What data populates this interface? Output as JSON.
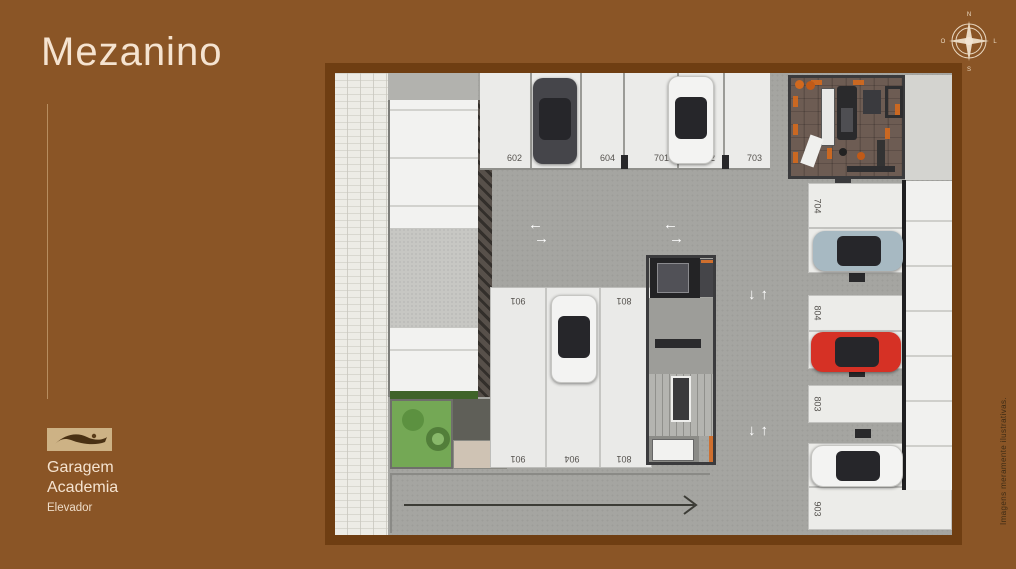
{
  "title": "Mezanino",
  "legend": {
    "line1": "Garagem",
    "line2": "Academia",
    "sub": "Elevador"
  },
  "compass": {
    "n": "N",
    "s": "S",
    "e": "L",
    "w": "O"
  },
  "disclaimer": "Imagens meramente ilustrativas.",
  "icons": {
    "arrow_left": "←",
    "arrow_right": "→",
    "arrow_up": "↑",
    "arrow_down": "↓",
    "ramp_arrow_direction": "right"
  },
  "colors": {
    "background": "#8a5526",
    "plan_frame": "#6f3e12",
    "accent_text": "#f5e3d0",
    "gym_accent_orange": "#d2691e",
    "car_red": "#d63125",
    "car_silver_blue": "#a7b9c2",
    "car_dark_gray": "#45454a",
    "car_white": "#f3f3f2"
  },
  "plan": {
    "top_row": [
      {
        "number": "602",
        "car": "none"
      },
      {
        "number": "603",
        "car": "dark-gray"
      },
      {
        "number": "604",
        "car": "none"
      },
      {
        "number": "701",
        "car": "none"
      },
      {
        "number": "702",
        "car": "white"
      },
      {
        "number": "703",
        "car": "none"
      }
    ],
    "right_column": [
      {
        "number": "704",
        "car": "none"
      },
      {
        "number": "802",
        "car": "silver-blue"
      },
      {
        "number": "804",
        "car": "none"
      },
      {
        "number": "804",
        "car": "red"
      },
      {
        "number": "803",
        "car": "none"
      },
      {
        "number": "902",
        "car": "white"
      },
      {
        "number": "903",
        "car": "none"
      }
    ],
    "center_block": [
      {
        "number": "901",
        "car": "none"
      },
      {
        "number": "904",
        "car": "white"
      },
      {
        "number": "801",
        "car": "none"
      }
    ]
  }
}
